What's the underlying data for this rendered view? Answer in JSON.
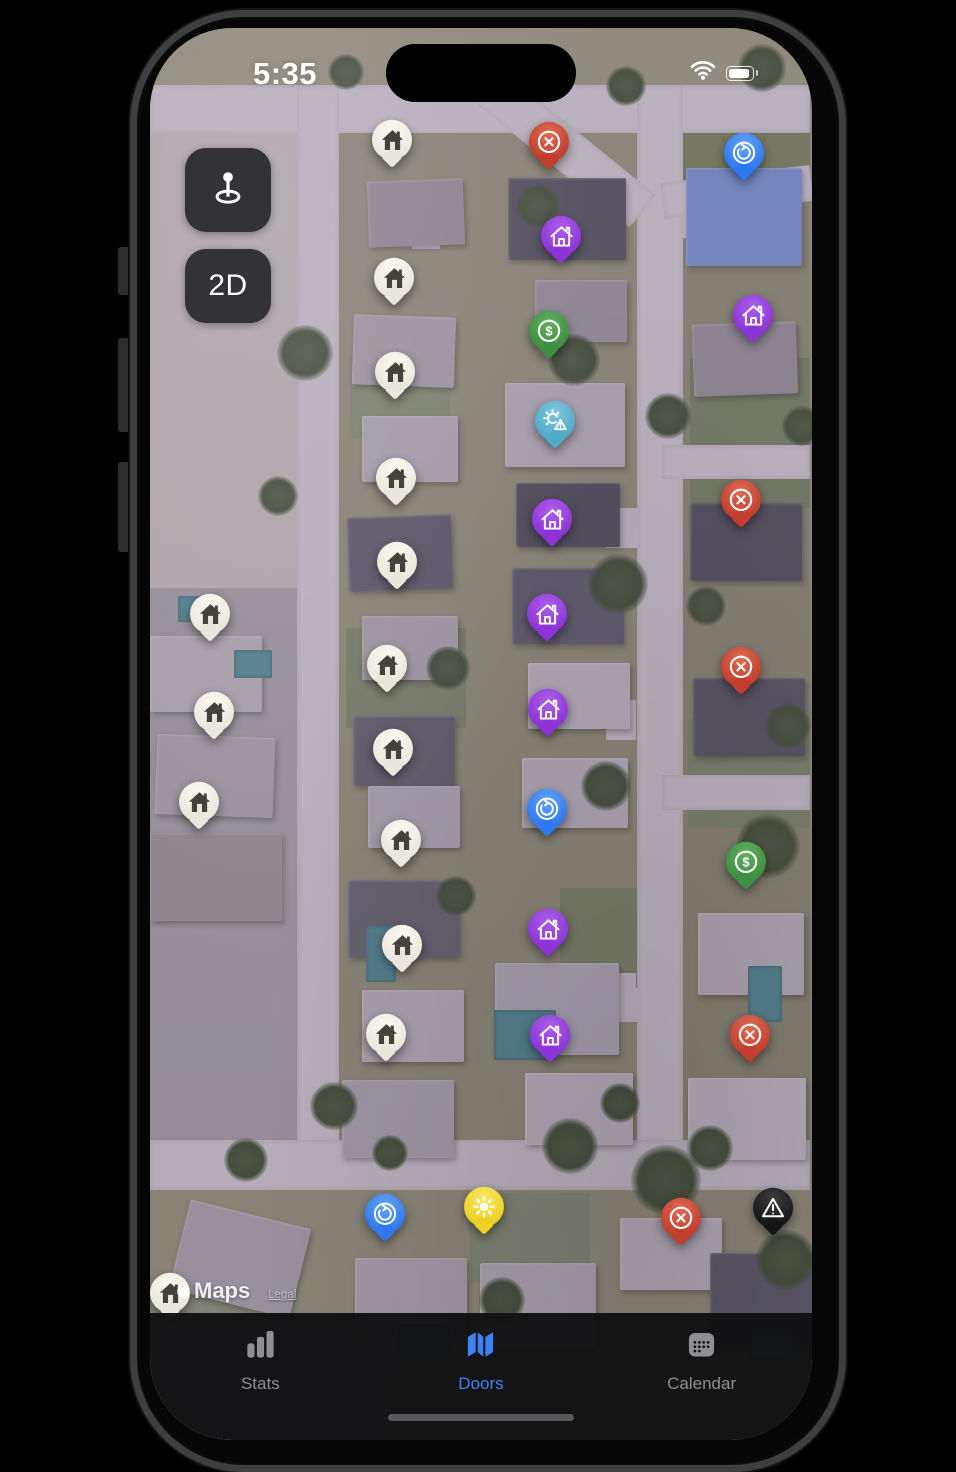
{
  "status_bar": {
    "time": "5:35"
  },
  "map_controls": {
    "mode_button_label": "2D"
  },
  "attribution": {
    "brand": "Maps",
    "legal_label": "Legal"
  },
  "tab_bar": {
    "active_color": "#3b82f7",
    "inactive_color": "#8e8e93",
    "tabs": [
      {
        "id": "stats",
        "label": "Stats",
        "icon": "bar-chart-icon",
        "active": false
      },
      {
        "id": "doors",
        "label": "Doors",
        "icon": "folded-map-icon",
        "active": true
      },
      {
        "id": "calendar",
        "label": "Calendar",
        "icon": "calendar-icon",
        "active": false
      }
    ]
  },
  "markers": {
    "types": {
      "white-house": {
        "icon": "house-filled-icon",
        "pin_color": "#e9e7db",
        "pin_color_light": "#fbfaf2",
        "icon_color": "#44423a"
      },
      "purple-house": {
        "icon": "house-outline-icon",
        "pin_color": "#8d33d8",
        "pin_color_light": "#aa5fe8",
        "icon_color": "#ffffff"
      },
      "red-x": {
        "icon": "circle-x-icon",
        "pin_color": "#c23d2d",
        "pin_color_light": "#de6b52",
        "icon_color": "#ffffff"
      },
      "blue-refresh": {
        "icon": "circle-refresh-icon",
        "pin_color": "#2e78f0",
        "pin_color_light": "#62a3f8",
        "icon_color": "#ffffff"
      },
      "green-dollar": {
        "icon": "circle-dollar-icon",
        "pin_color": "#3d8f41",
        "pin_color_light": "#63ae5e",
        "icon_color": "#ffffff"
      },
      "cyan-sun-alert": {
        "icon": "sun-alert-icon",
        "pin_color": "#4fa9c8",
        "pin_color_light": "#82c6db",
        "icon_color": "#ffffff"
      },
      "yellow-sun": {
        "icon": "sun-icon",
        "pin_color": "#ecd024",
        "pin_color_light": "#f8e765",
        "icon_color": "#ffffff"
      },
      "black-warning": {
        "icon": "warning-triangle-icon",
        "pin_color": "#161616",
        "pin_color_light": "#3d3d3d",
        "icon_color": "#ffffff"
      }
    },
    "pins": [
      {
        "type": "white-house",
        "x": 242,
        "y": 115
      },
      {
        "type": "red-x",
        "x": 399,
        "y": 117
      },
      {
        "type": "blue-refresh",
        "x": 594,
        "y": 128
      },
      {
        "type": "purple-house",
        "x": 411,
        "y": 211
      },
      {
        "type": "white-house",
        "x": 244,
        "y": 253
      },
      {
        "type": "purple-house",
        "x": 603,
        "y": 290
      },
      {
        "type": "green-dollar",
        "x": 399,
        "y": 306
      },
      {
        "type": "white-house",
        "x": 245,
        "y": 347
      },
      {
        "type": "cyan-sun-alert",
        "x": 405,
        "y": 396
      },
      {
        "type": "white-house",
        "x": 246,
        "y": 453
      },
      {
        "type": "red-x",
        "x": 591,
        "y": 475
      },
      {
        "type": "purple-house",
        "x": 402,
        "y": 494
      },
      {
        "type": "white-house",
        "x": 247,
        "y": 537
      },
      {
        "type": "white-house",
        "x": 60,
        "y": 589
      },
      {
        "type": "purple-house",
        "x": 397,
        "y": 589
      },
      {
        "type": "white-house",
        "x": 237,
        "y": 640
      },
      {
        "type": "red-x",
        "x": 591,
        "y": 642
      },
      {
        "type": "purple-house",
        "x": 398,
        "y": 684
      },
      {
        "type": "white-house",
        "x": 64,
        "y": 687
      },
      {
        "type": "white-house",
        "x": 243,
        "y": 724
      },
      {
        "type": "white-house",
        "x": 49,
        "y": 777
      },
      {
        "type": "blue-refresh",
        "x": 397,
        "y": 784
      },
      {
        "type": "white-house",
        "x": 251,
        "y": 815
      },
      {
        "type": "green-dollar",
        "x": 596,
        "y": 837
      },
      {
        "type": "purple-house",
        "x": 398,
        "y": 904
      },
      {
        "type": "white-house",
        "x": 252,
        "y": 920
      },
      {
        "type": "white-house",
        "x": 236,
        "y": 1009
      },
      {
        "type": "purple-house",
        "x": 400,
        "y": 1010
      },
      {
        "type": "red-x",
        "x": 600,
        "y": 1010
      },
      {
        "type": "yellow-sun",
        "x": 334,
        "y": 1182
      },
      {
        "type": "black-warning",
        "x": 623,
        "y": 1183
      },
      {
        "type": "blue-refresh",
        "x": 235,
        "y": 1189
      },
      {
        "type": "red-x",
        "x": 531,
        "y": 1193
      },
      {
        "type": "white-house",
        "x": 20,
        "y": 1268
      }
    ]
  }
}
